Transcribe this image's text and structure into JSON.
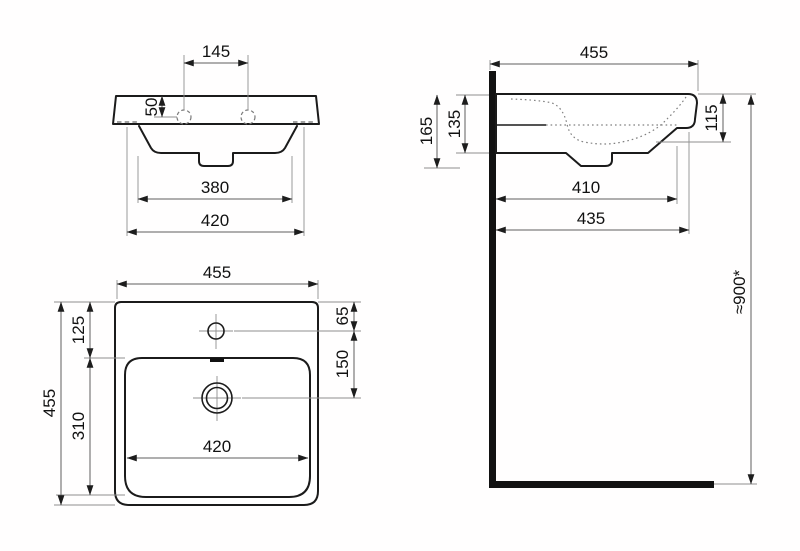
{
  "drawing": {
    "type": "washbasin-technical-dimension-drawing",
    "units": "mm",
    "front_view": {
      "tap_holes_spacing": "145",
      "rim_top_to_tap_hole": "50",
      "base_width": "380",
      "body_width": "420"
    },
    "side_view": {
      "rim_depth": "455",
      "overall_height_with_trap": "165",
      "body_height": "135",
      "bowl_inner_depth": "115",
      "base_length": "410",
      "body_length": "435",
      "mounting_height": "≈900*"
    },
    "plan_view": {
      "rim_width": "455",
      "back_edge_to_bowl": "125",
      "back_edge_to_tap_hole": "65",
      "tap_hole_to_drain": "150",
      "bowl_length": "310",
      "overall_depth": "455",
      "bowl_width": "420"
    }
  }
}
